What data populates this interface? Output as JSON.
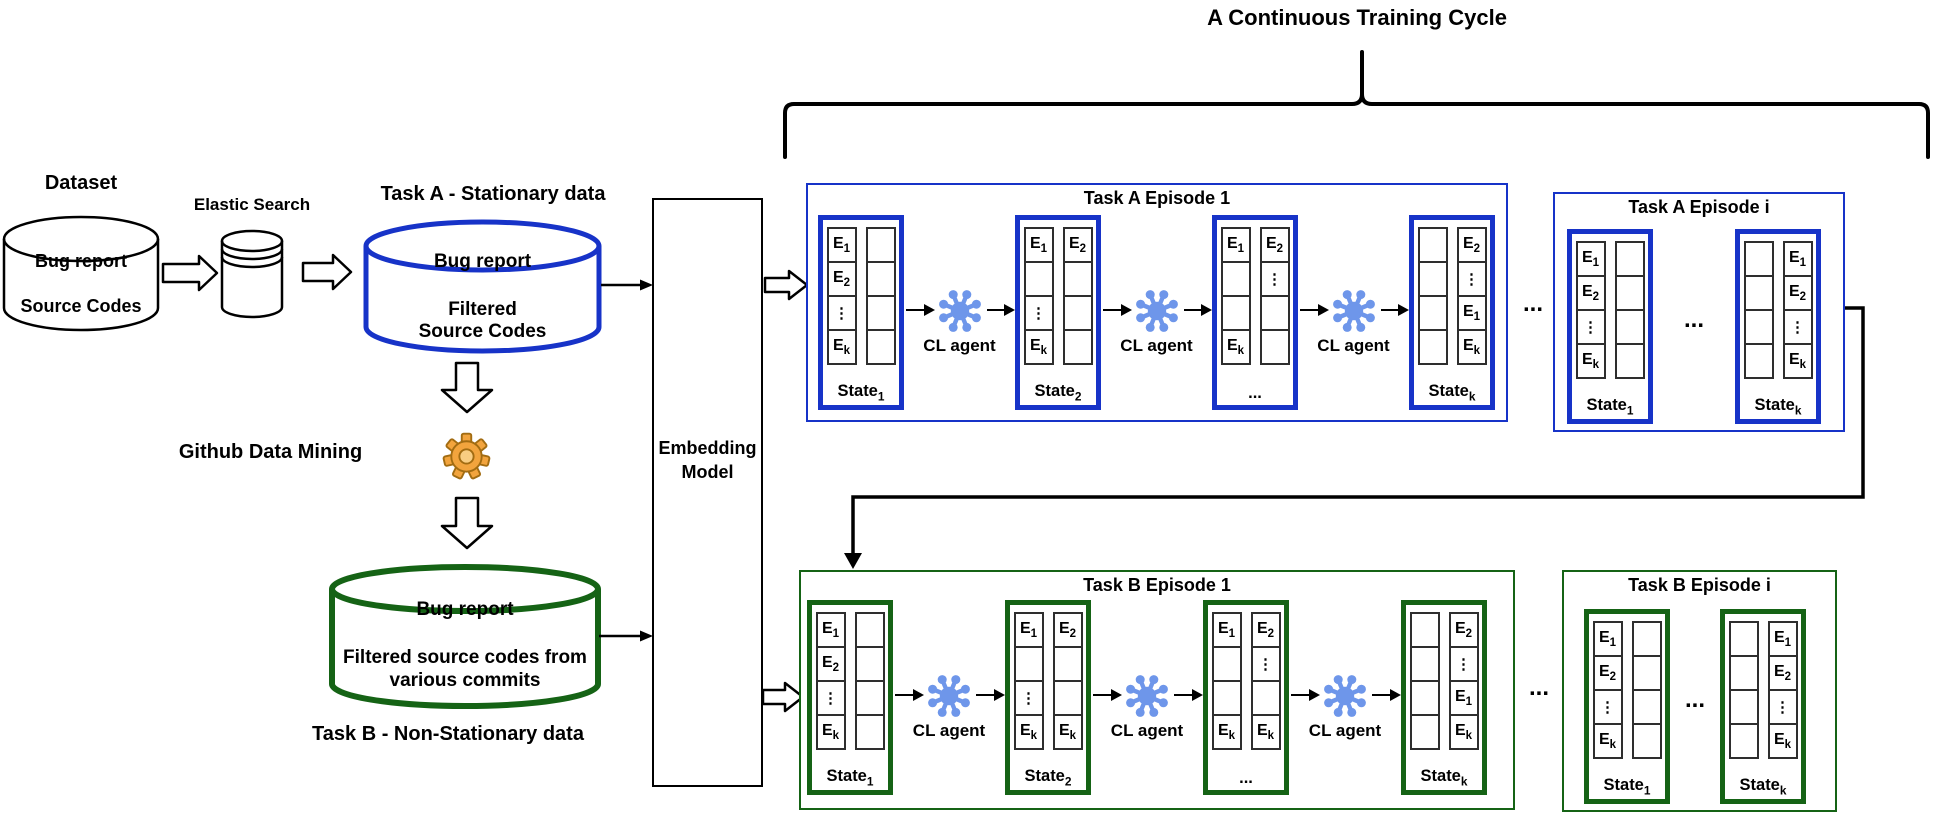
{
  "header": {
    "title": "A Continuous Training Cycle"
  },
  "ellipsis": "...",
  "colors": {
    "task_a_accent": "#1733c8",
    "task_b_accent": "#156315",
    "agent_blue": "#6e96ea",
    "gear_orange": "#f2a43d",
    "line_black": "#000000"
  },
  "pipeline": {
    "dataset": {
      "title": "Dataset",
      "lines": [
        "Bug report",
        "Source Codes"
      ]
    },
    "elastic_search": {
      "label": "Elastic Search"
    },
    "task_a_store": {
      "title": "Task A - Stationary data",
      "lines": [
        "Bug report",
        "Filtered",
        "Source Codes"
      ]
    },
    "github_mining": {
      "label": "Github Data Mining"
    },
    "task_b_store": {
      "title": "Task B - Non-Stationary data",
      "lines": [
        "Bug report",
        "Filtered source codes from",
        "various commits"
      ]
    },
    "embedding_model": {
      "lines": [
        "Embedding",
        "Model"
      ]
    }
  },
  "episodes": [
    {
      "key": "a1",
      "title": "Task A Episode 1",
      "theme": "blue",
      "sequence": [
        {
          "state": {
            "label": "State_1",
            "left": [
              "E_1",
              "E_2",
              "⋮",
              "E_k"
            ],
            "right": [
              "",
              "",
              "",
              ""
            ]
          }
        },
        {
          "agent": "CL agent"
        },
        {
          "state": {
            "label": "State_2",
            "left": [
              "E_1",
              "",
              "⋮",
              "E_k"
            ],
            "right": [
              "E_2",
              "",
              "",
              ""
            ]
          }
        },
        {
          "agent": "CL agent"
        },
        {
          "state": {
            "label": "...",
            "left": [
              "E_1",
              "",
              "",
              "E_k"
            ],
            "right": [
              "E_2",
              "⋮",
              "",
              ""
            ]
          }
        },
        {
          "agent": "CL agent"
        },
        {
          "state": {
            "label": "State_k",
            "left": [
              "",
              "",
              "",
              ""
            ],
            "right": [
              "E_2",
              "⋮",
              "E_1",
              "E_k"
            ]
          }
        }
      ]
    },
    {
      "key": "ai",
      "title": "Task A Episode i",
      "theme": "blue",
      "sequence": [
        {
          "state": {
            "label": "State_1",
            "left": [
              "E_1",
              "E_2",
              "⋮",
              "E_k"
            ],
            "right": [
              "",
              "",
              "",
              ""
            ]
          }
        },
        {
          "dots": "..."
        },
        {
          "state": {
            "label": "State_k",
            "left": [
              "",
              "",
              "",
              ""
            ],
            "right": [
              "E_1",
              "E_2",
              "⋮",
              "E_k"
            ]
          }
        }
      ]
    },
    {
      "key": "b1",
      "title": "Task B Episode 1",
      "theme": "green",
      "sequence": [
        {
          "state": {
            "label": "State_1",
            "left": [
              "E_1",
              "E_2",
              "⋮",
              "E_k"
            ],
            "right": [
              "",
              "",
              "",
              ""
            ]
          }
        },
        {
          "agent": "CL agent"
        },
        {
          "state": {
            "label": "State_2",
            "left": [
              "E_1",
              "",
              "⋮",
              "E_k"
            ],
            "right": [
              "E_2",
              "",
              "",
              "E_k"
            ]
          }
        },
        {
          "agent": "CL agent"
        },
        {
          "state": {
            "label": "...",
            "left": [
              "E_1",
              "",
              "",
              "E_k"
            ],
            "right": [
              "E_2",
              "⋮",
              "",
              "E_k"
            ]
          }
        },
        {
          "agent": "CL agent"
        },
        {
          "state": {
            "label": "State_k",
            "left": [
              "",
              "",
              "",
              ""
            ],
            "right": [
              "E_2",
              "⋮",
              "E_1",
              "E_k"
            ]
          }
        }
      ]
    },
    {
      "key": "bi",
      "title": "Task B Episode i",
      "theme": "green",
      "sequence": [
        {
          "state": {
            "label": "State_1",
            "left": [
              "E_1",
              "E_2",
              "⋮",
              "E_k"
            ],
            "right": [
              "",
              "",
              "",
              ""
            ]
          }
        },
        {
          "dots": "..."
        },
        {
          "state": {
            "label": "State_k",
            "left": [
              "",
              "",
              "",
              ""
            ],
            "right": [
              "E_1",
              "E_2",
              "⋮",
              "E_k"
            ]
          }
        }
      ]
    }
  ]
}
